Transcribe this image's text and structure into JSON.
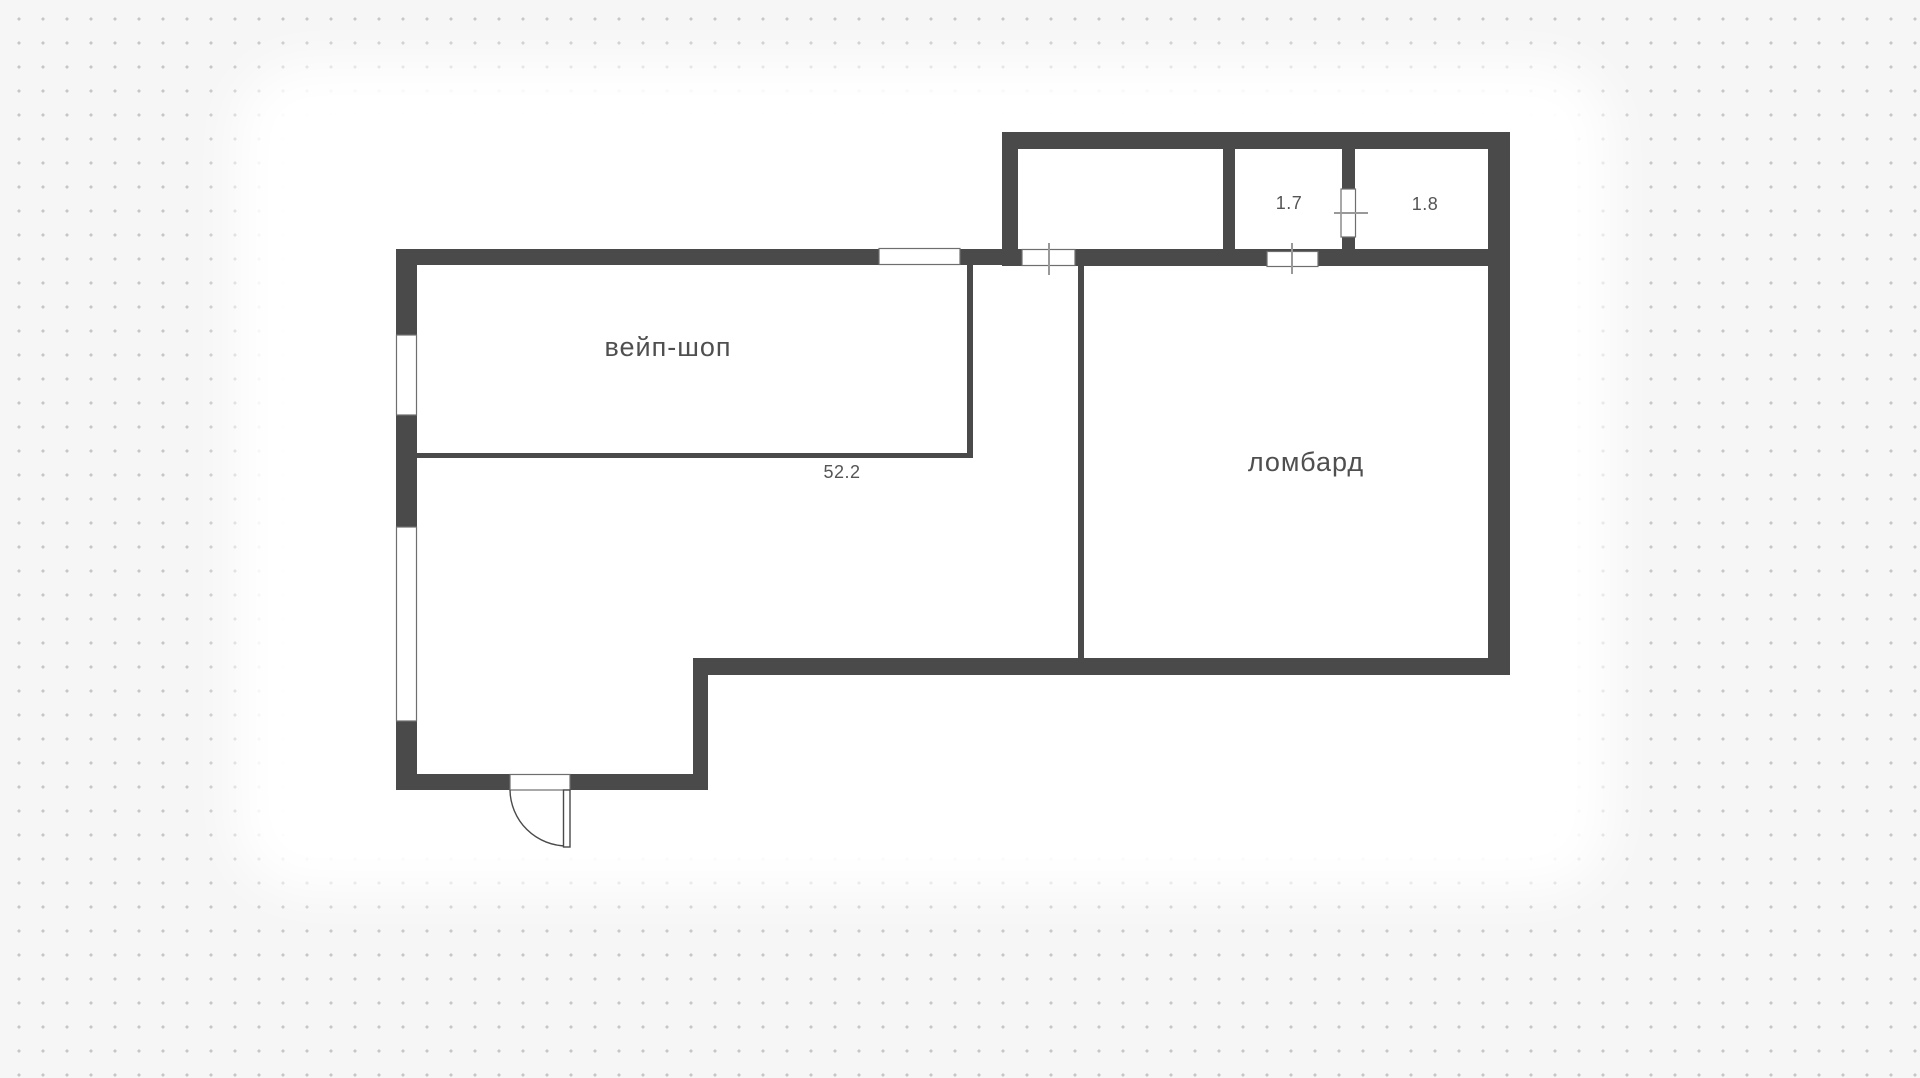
{
  "plan": {
    "labels": {
      "vape_shop": "вейп-шоп",
      "vape_shop_area": "52.2",
      "pawnshop": "ломбард",
      "small_room_1": "1.7",
      "small_room_2": "1.8"
    },
    "colors": {
      "wall": "#4a4a4a",
      "background": "#f6f6f6",
      "dots": "#c6c6c6",
      "floor": "#ffffff",
      "text": "#4f4f4f",
      "tick": "#999999"
    }
  }
}
